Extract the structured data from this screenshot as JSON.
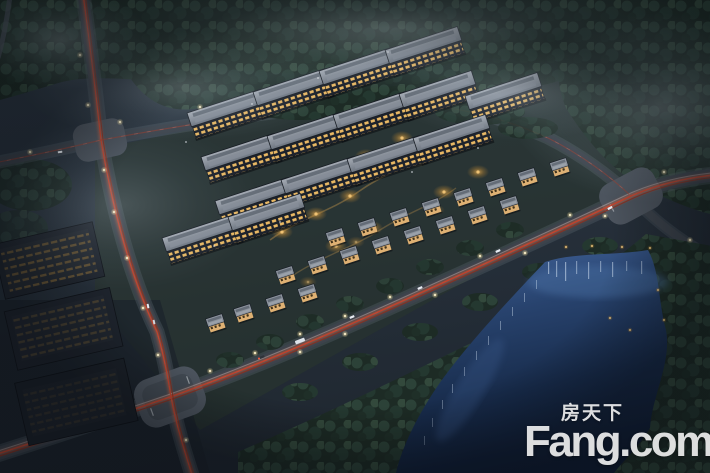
{
  "watermark": {
    "chinese": "房天下",
    "english": "Fang.com"
  },
  "palette": {
    "night_ground": "#28323d",
    "forest_dark": "#1d2b25",
    "forest_mid": "#2c4238",
    "mist_blue": "#a9bac7",
    "road_asphalt": "#3c434c",
    "intersection_pavement": "#4c545e",
    "traffic_trail_red": "#c6402a",
    "street_lamp": "#fff4cf",
    "apartment_roof": "#8d949e",
    "apartment_facade": "#1d222b",
    "window_warm": "#eab964",
    "villa_wall": "#dfb173",
    "garden_glow": "#c98e33",
    "lake_deep": "#0f1c33",
    "lake_light": "#41639a",
    "reflection_streak": "#d7e5f5",
    "watermark_white": "rgba(255,255,255,0.86)"
  }
}
